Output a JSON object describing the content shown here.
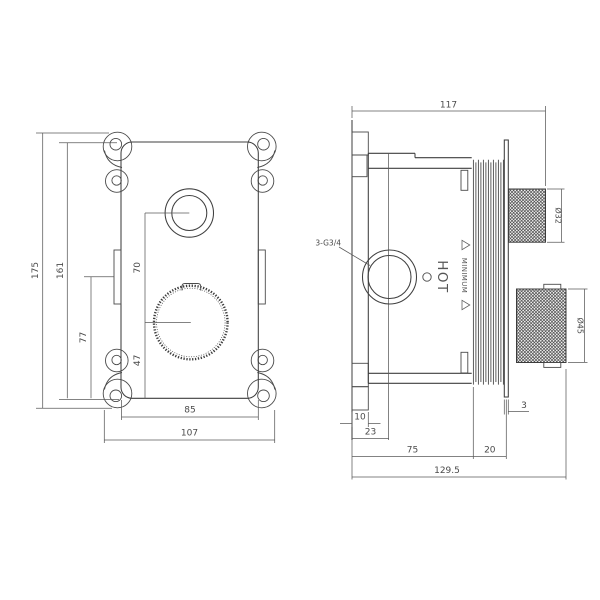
{
  "drawing": {
    "front_view": {
      "dim_overall_height": "175",
      "dim_body_height": "161",
      "dim_slot_to_bottom": "77",
      "dim_knob_centers": "70",
      "dim_knob_center_to_bottom": "47",
      "dim_body_width": "85",
      "dim_overall_width": "107"
    },
    "side_view": {
      "dim_overall_width": "117",
      "dim_tab_width": "10",
      "dim_port_center_offset": "23",
      "dim_body_depth": "75",
      "dim_rib_section_depth": "20",
      "dim_trim_plate_thickness": "3",
      "dim_overall_depth": "129.5",
      "dim_upper_knob_diameter": "Ø32",
      "dim_lower_knob_diameter": "Ø45",
      "label_port_thread": "3-G3/4",
      "label_hot": "HOT",
      "label_minimum": "MINIMUM"
    },
    "colors": {
      "line": "#3f3f3f",
      "dimension": "#5a5a5a",
      "background": "#ffffff"
    }
  }
}
